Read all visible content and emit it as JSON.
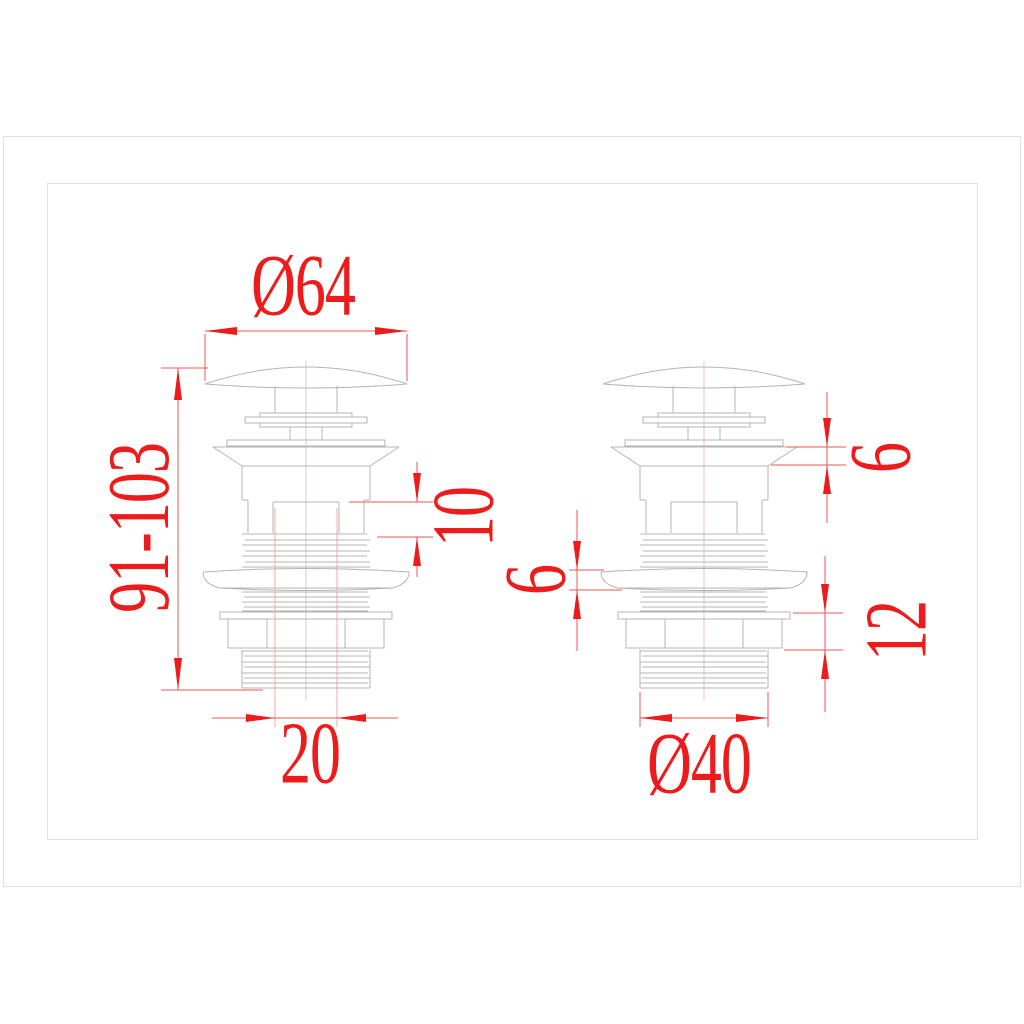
{
  "diagram": {
    "type": "technical-drawing",
    "subject": "pop-up basin waste drain with dome cap, threaded body, sealing flange and lock nut — two side views with dimensions in mm",
    "views": [
      {
        "id": "left-view",
        "dimensions": [
          {
            "name": "cap-diameter",
            "label": "Ø64",
            "orientation": "horizontal"
          },
          {
            "name": "overall-height-range",
            "label": "91-103",
            "orientation": "vertical"
          },
          {
            "name": "bore-offset",
            "label": "10",
            "orientation": "vertical"
          },
          {
            "name": "inner-bore",
            "label": "20",
            "orientation": "horizontal"
          }
        ]
      },
      {
        "id": "right-view",
        "dimensions": [
          {
            "name": "flange-lip-height",
            "label": "6",
            "orientation": "vertical"
          },
          {
            "name": "seal-washer-thickness",
            "label": "6",
            "orientation": "vertical"
          },
          {
            "name": "washer-nut-stack",
            "label": "12",
            "orientation": "vertical"
          },
          {
            "name": "thread-diameter",
            "label": "Ø40",
            "orientation": "horizontal"
          }
        ]
      }
    ],
    "colors": {
      "dimension_red": "#ed1c1c",
      "dimension_line": "#ee5555",
      "extension_pink": "#f0a8a8",
      "centerline_pink": "#edb0b0",
      "linework_gray": "#b4b4b4",
      "frame_gray": "#dfdfdf"
    }
  }
}
